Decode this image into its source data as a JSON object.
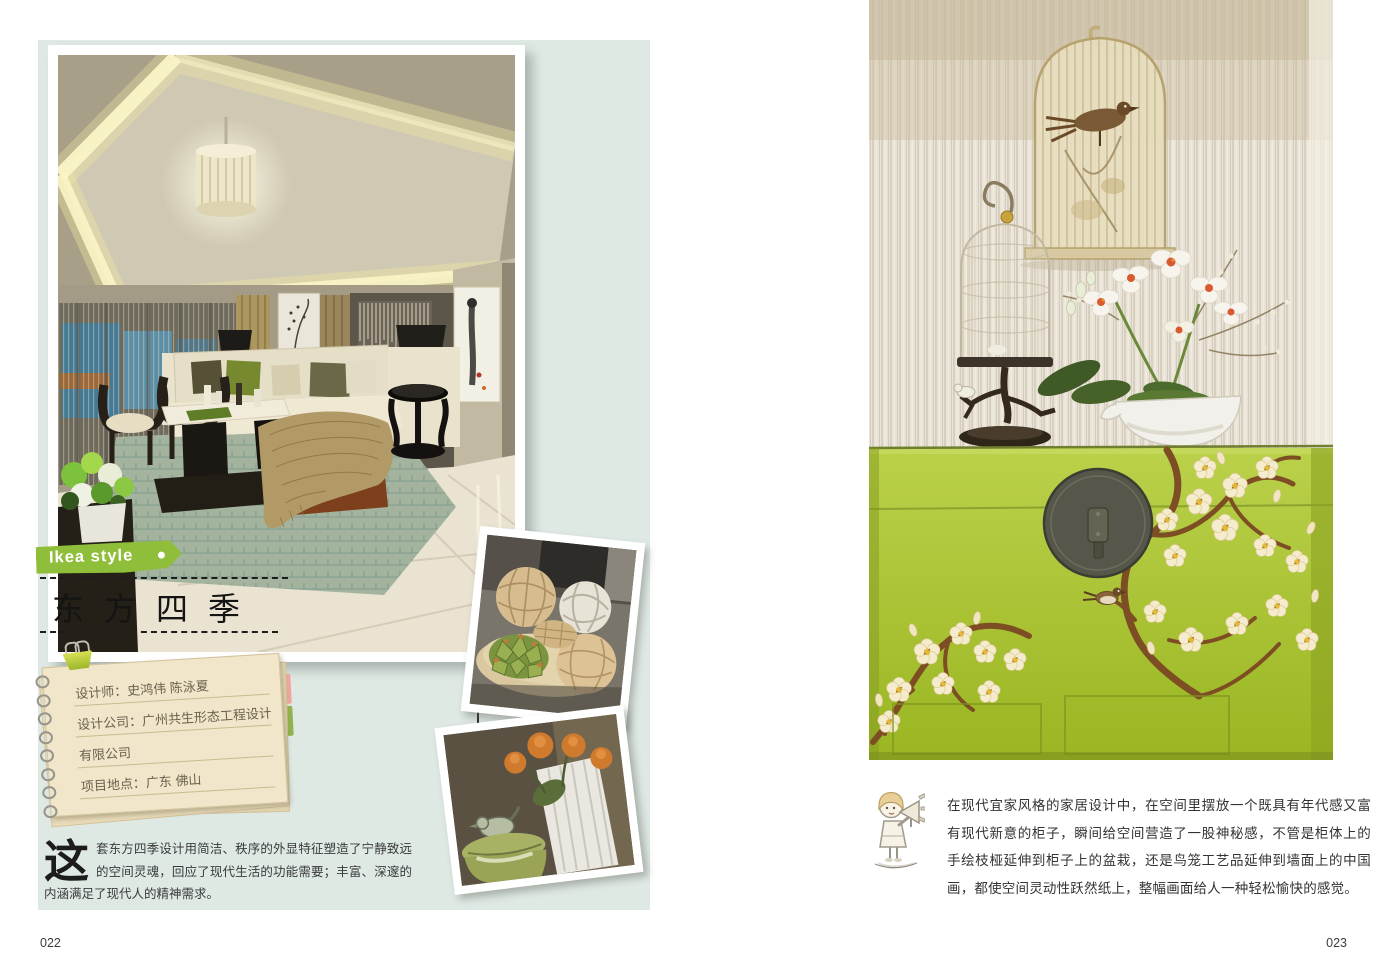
{
  "left_page": {
    "banner_label": "Ikea style",
    "title": "东方四季",
    "note_lines": [
      "设计师：史鸿伟 陈泳夏",
      "设计公司：广州共生形态工程设计",
      "有限公司",
      "项目地点：广东 佛山"
    ],
    "intro_drop_cap": "这",
    "intro_body": "套东方四季设计用简洁、秩序的外显特征塑造了宁静致远的空间灵魂，回应了现代生活的功能需要；丰富、深邃的内涵满足了现代人的精神需求。",
    "page_number": "022"
  },
  "right_page": {
    "caption": "在现代宜家风格的家居设计中，在空间里摆放一个既具有年代感又富有现代新意的柜子，瞬间给空间营造了一股神秘感，不管是柜体上的手绘枝桠延伸到柜子上的盆栽，还是鸟笼工艺品延伸到墙面上的中国画，都使空间灵动性跃然纸上，整幅画面给人一种轻松愉快的感觉。",
    "page_number": "023"
  },
  "icons": {
    "announcer": "kid-with-megaphone",
    "banner_dot": "white-dot"
  },
  "colors": {
    "accent_green": "#8fbe3a",
    "panel_mint": "#dfe9e4",
    "note_paper": "#f1e6c9",
    "cabinet_green": "#a9c636"
  }
}
